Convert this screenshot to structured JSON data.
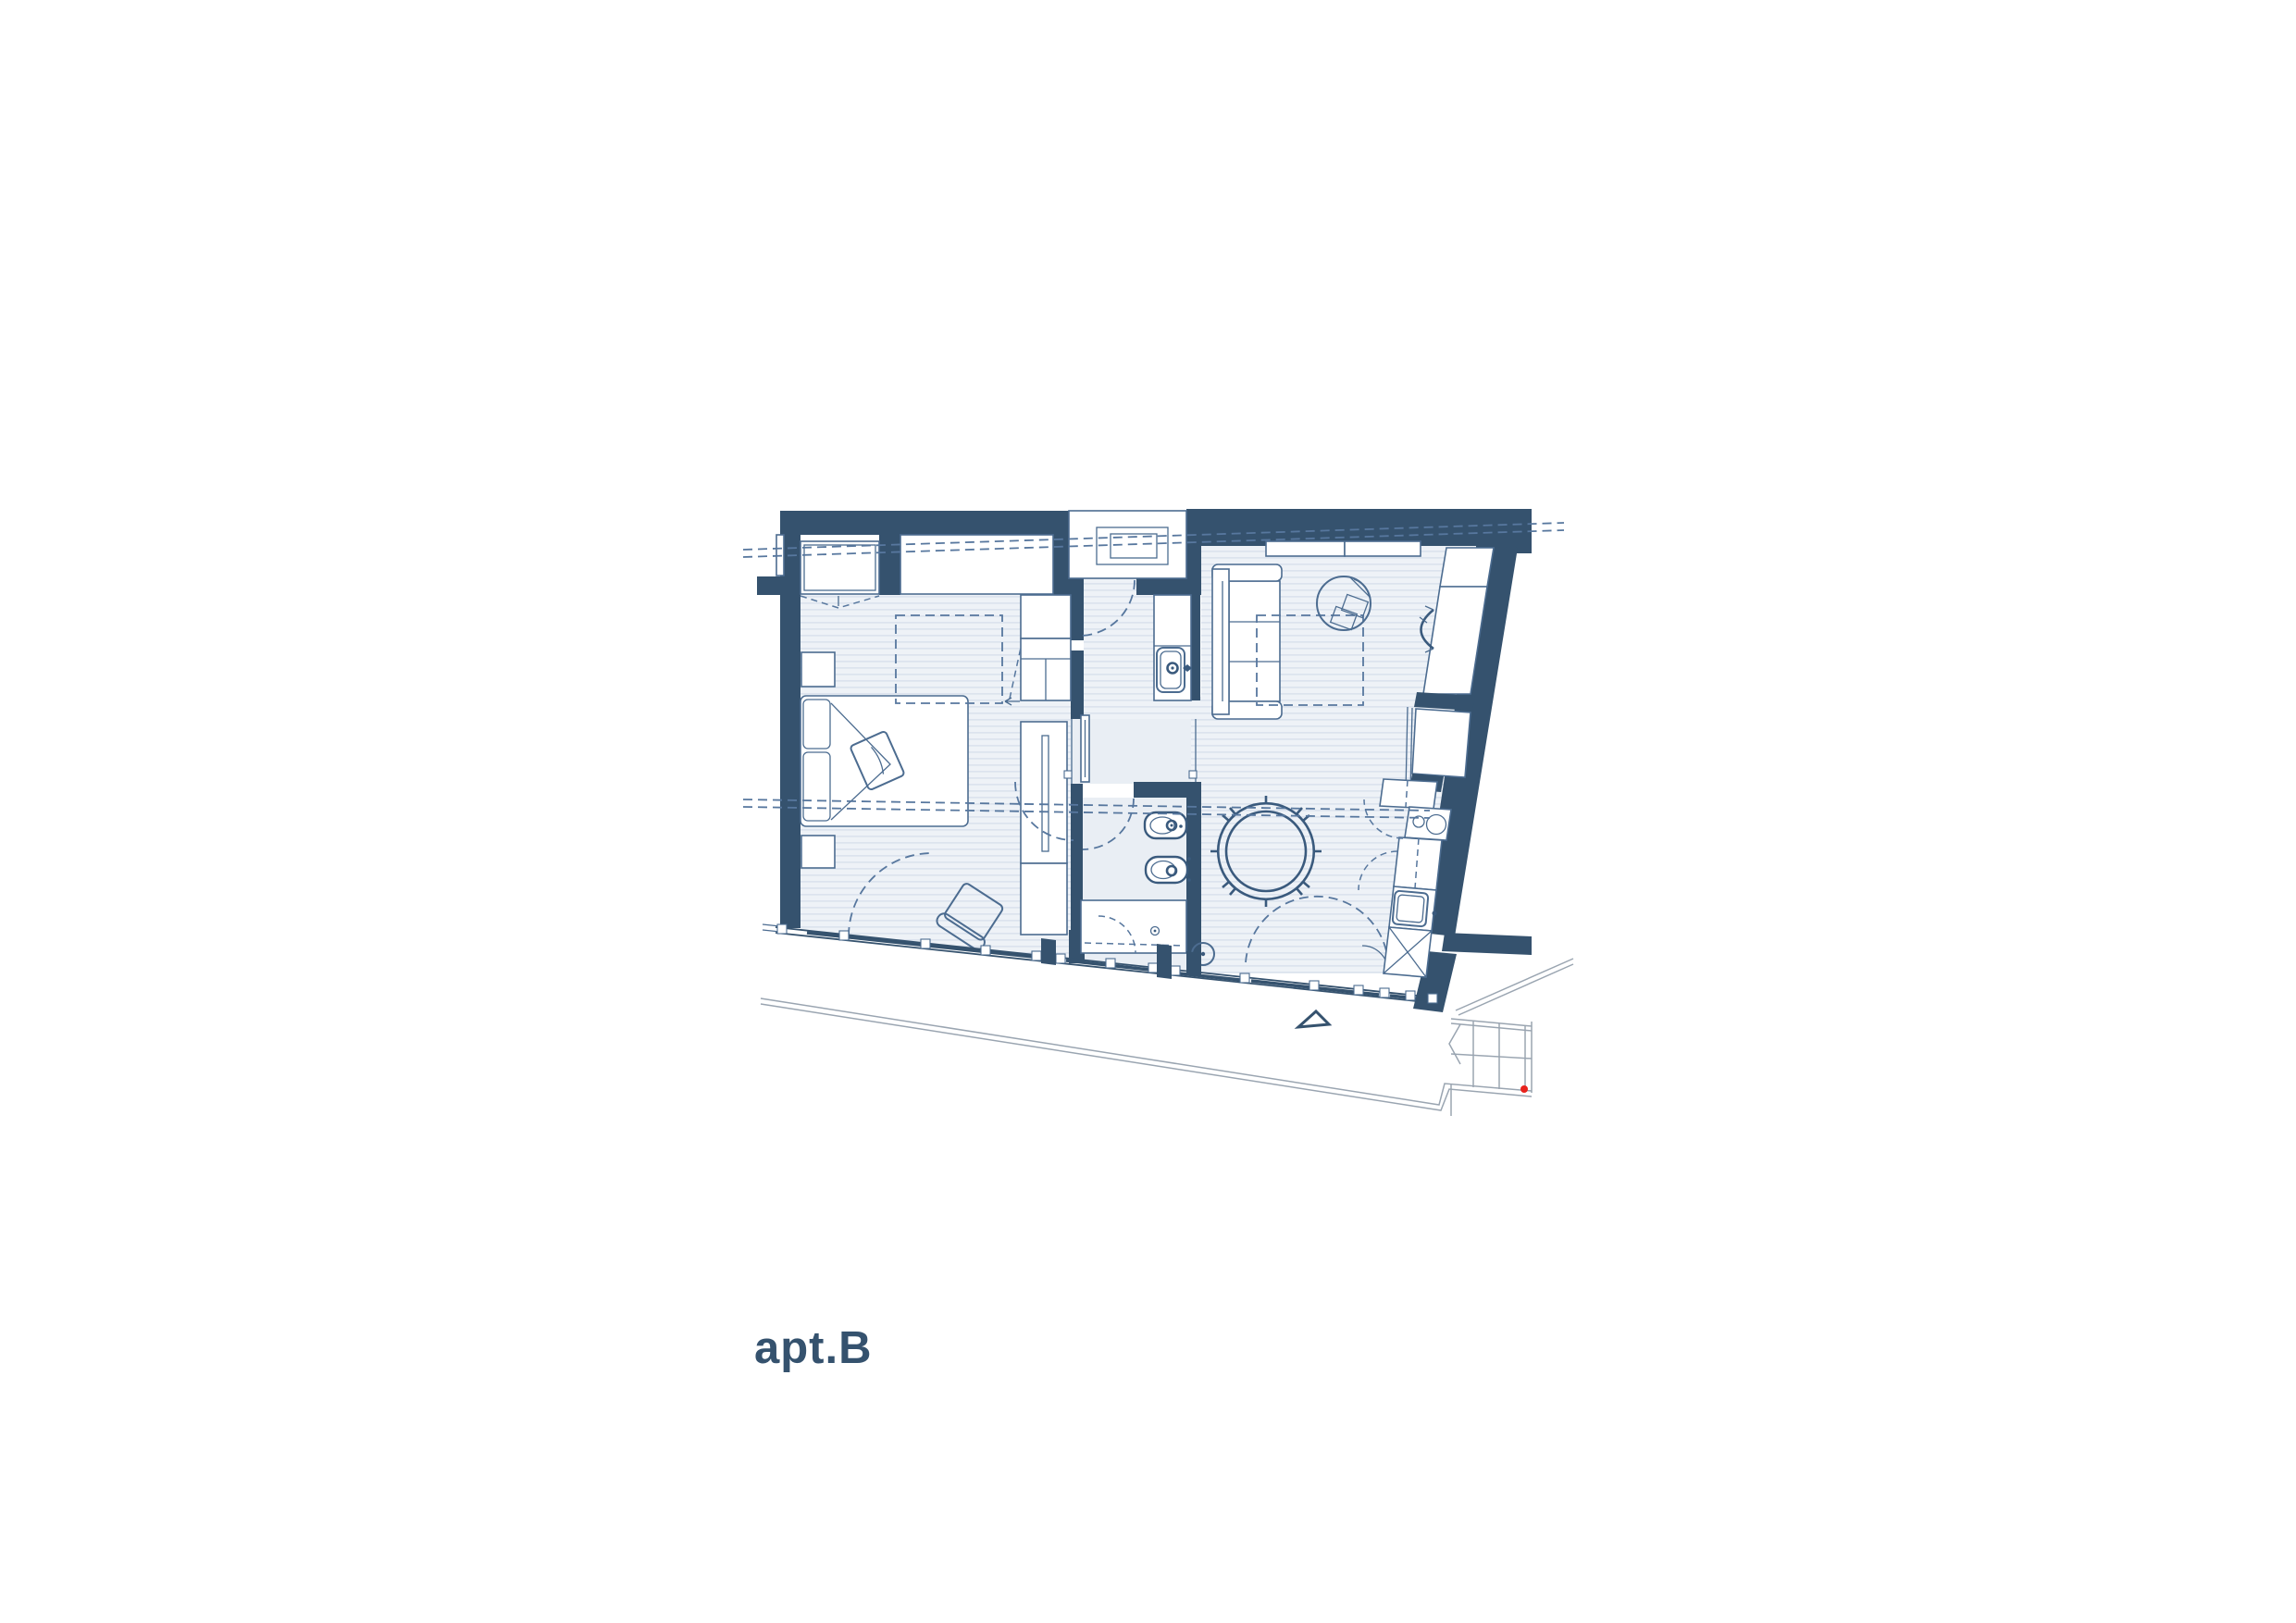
{
  "label": {
    "text": "apt.B"
  },
  "colors": {
    "wall": "#35526e",
    "line": "#4c6c90",
    "line_strong": "#3a5a7d",
    "dash": "#57779e",
    "floor": "#eef2f7",
    "floor_stripe": "#dce3ee",
    "floor_plain": "#e9eef4",
    "gray": "#9aa5b1",
    "red": "#e8231d",
    "paper": "#ffffff"
  },
  "elements": [
    "exterior-walls",
    "interior-partitions",
    "window",
    "entry-niche",
    "entry-door-swing",
    "bed",
    "pillows",
    "blanket",
    "nightstand",
    "armchair",
    "wardrobe",
    "closet-shelves",
    "dashed-overhead-cabinet",
    "washbasin",
    "bidet",
    "toilet",
    "shower",
    "shower-door-swing",
    "sofa",
    "rug-dashed",
    "round-desk-rug",
    "wall-folding-seat",
    "dining-table",
    "dining-chairs",
    "stool",
    "kitchen-counter",
    "hob",
    "sink",
    "appliance-x-box",
    "service-shaft",
    "sliding-glass-doors",
    "terrace-edge",
    "stairs",
    "direction-triangle",
    "survey-red-dot",
    "section-dashed-lines"
  ]
}
